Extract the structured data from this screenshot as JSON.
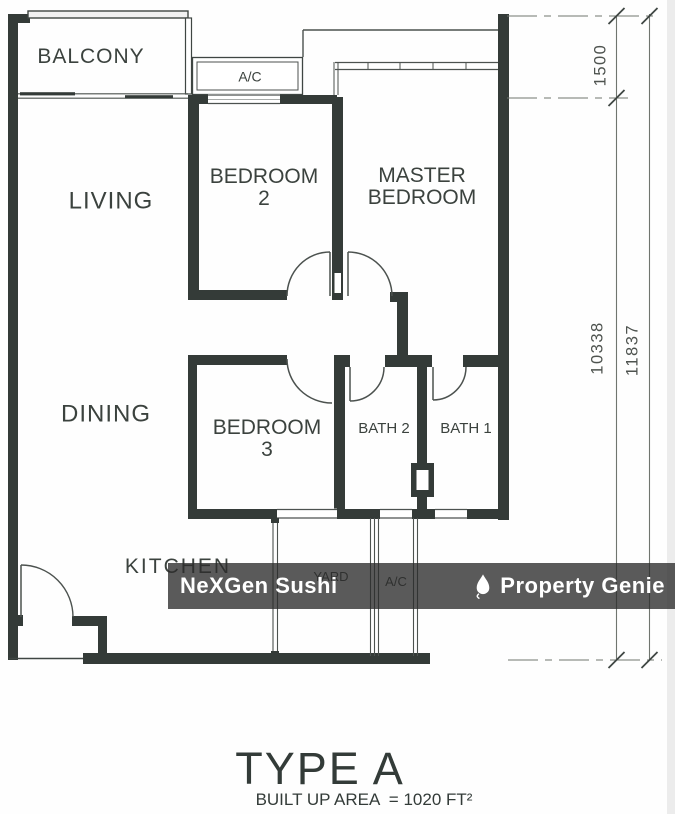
{
  "plan": {
    "rooms": {
      "balcony": "BALCONY",
      "ac_top": "A/C",
      "living": "LIVING",
      "bedroom2_line1": "BEDROOM",
      "bedroom2_line2": "2",
      "master_line1": "MASTER",
      "master_line2": "BEDROOM",
      "dining": "DINING",
      "bedroom3_line1": "BEDROOM",
      "bedroom3_line2": "3",
      "bath2": "BATH 2",
      "bath1": "BATH 1",
      "kitchen": "KITCHEN",
      "yard": "YARD",
      "ac_yard": "A/C"
    },
    "dimensions": {
      "top_right": "1500",
      "inner_height": "10338",
      "outer_height": "11837"
    }
  },
  "watermark": {
    "left_text": "NeXGen Sushi",
    "right_text": "Property Genie",
    "right_icon": "flame-pin-icon"
  },
  "title": {
    "heading": "TYPE A",
    "subheading": "BUILT UP AREA  = 1020 FT²"
  },
  "colors": {
    "wall": "#343b38",
    "thin_line": "#4c524f",
    "dimension_line": "#70756f",
    "label_text": "#3b423e",
    "watermark_bar": "rgba(44,44,44,0.78)",
    "watermark_text": "#ffffff",
    "background": "#ffffff"
  }
}
